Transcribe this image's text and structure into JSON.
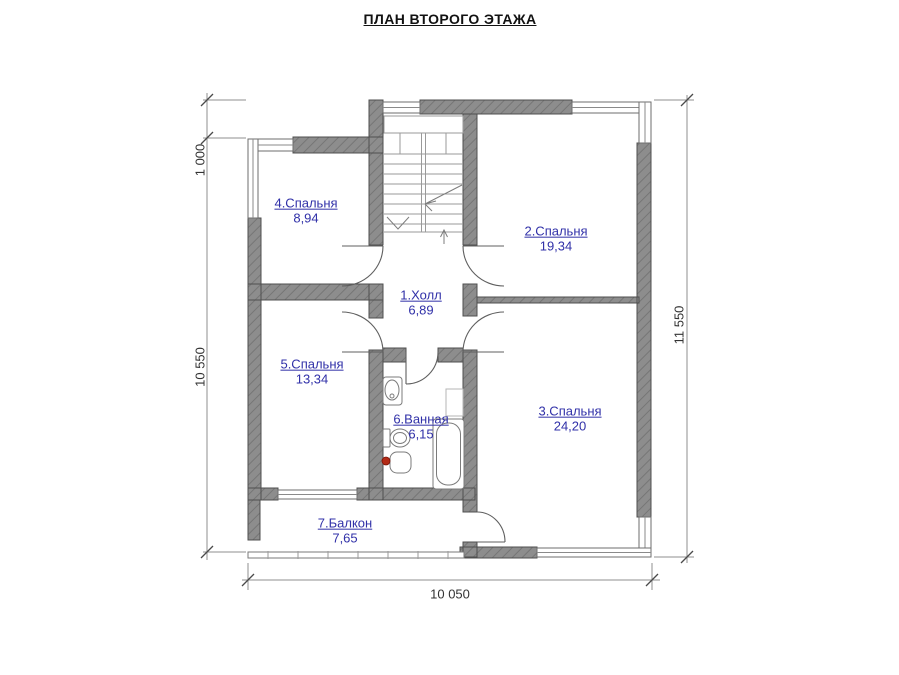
{
  "title": "ПЛАН ВТОРОГО ЭТАЖА",
  "colors": {
    "label_blue": "#3030a8",
    "wall_fill": "#8d8d8d",
    "wall_hatch": "#767676",
    "wall_edge": "#4f4f4f",
    "fixture_red": "#b32b17"
  },
  "rooms": [
    {
      "name": "1.Холл",
      "area": "6,89"
    },
    {
      "name": "2.Спальня",
      "area": "19,34"
    },
    {
      "name": "3.Спальня",
      "area": "24,20"
    },
    {
      "name": "4.Спальня",
      "area": "8,94"
    },
    {
      "name": "5.Спальня",
      "area": "13,34"
    },
    {
      "name": "6.Ванная",
      "area": "6,15"
    },
    {
      "name": "7.Балкон",
      "area": "7,65"
    }
  ],
  "dimensions": {
    "left_offset": "1 000",
    "left_total": "10 550",
    "right_total": "11 550",
    "bottom_total": "10 050"
  }
}
